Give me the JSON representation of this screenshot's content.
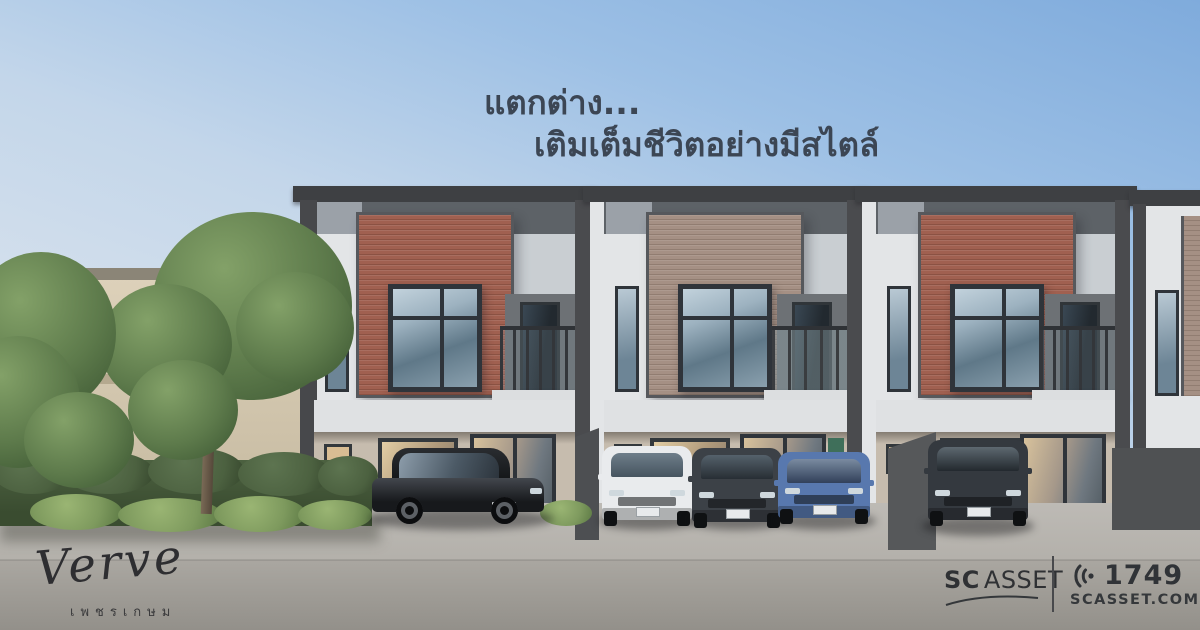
{
  "headline": {
    "line1": "แตกต่าง...",
    "line2": "เติมเต็มชีวิตอย่างมีสไตล์"
  },
  "project": {
    "name": "Verve",
    "location_th": "เพชรเกษม"
  },
  "brand": {
    "sc": "SC",
    "asset": "ASSET",
    "hotline": "1749",
    "website": "SCASSET.COM"
  },
  "icons": {
    "call_waves": "call-waves-icon",
    "sc_swoosh": "sc-swoosh-underline"
  },
  "scene": {
    "description": "3D render of modern two-storey townhomes with brick feature panels, five parked cars, trees and hedge on left, blue sky",
    "townhouse_units_visible": 4,
    "cars": [
      "black-sedan",
      "white-suv",
      "dark-gray-suv",
      "blue-sedan",
      "dark-suv"
    ]
  },
  "palette": {
    "headline": "#3c4654",
    "sky-top": "#7fabdc",
    "sky-mid": "#c3d6ea",
    "sky-low": "#e4e9ed",
    "eave": "#3e4043",
    "roof-band": "#5d6267",
    "pillar": "#4a4b4e",
    "wall-upper": "#e3e5e7",
    "wall-mid": "#dfe1e3",
    "wall-ground": "#c6bcae",
    "brick-red": "#a06050",
    "brick-red2": "#8b5243",
    "brick-taupe": "#a59084",
    "brick-taupe2": "#917d71",
    "frame": "#2f343a",
    "glass-hi": "#c2d2dc",
    "glass-lo": "#5f7888",
    "glass-warm": "#d9bd93",
    "pavement-top": "#bdbab5",
    "pavement-bot": "#93908a",
    "hedge": "#4c6140",
    "bush": "#7e9a5e",
    "tree": "#5d7a4b",
    "car-black": "#1e2023",
    "car-white": "#e9ebed",
    "car-dark": "#3c4147",
    "car-blue": "#5878ae",
    "car-dark2": "#34393f",
    "text-dark": "#2f3134"
  }
}
